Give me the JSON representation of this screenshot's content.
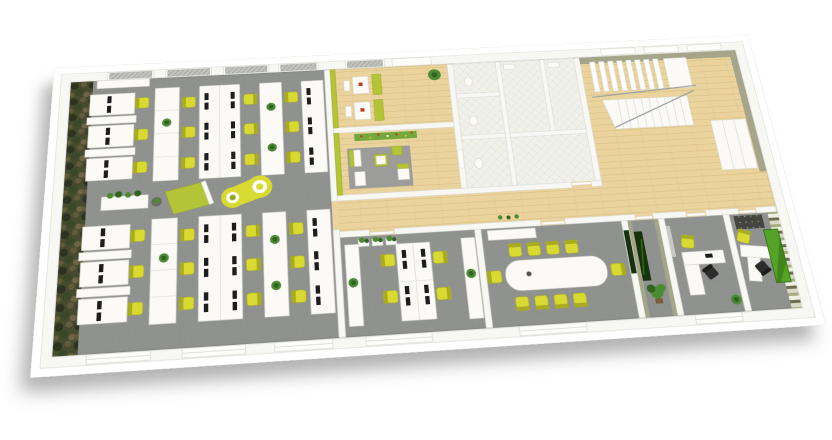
{
  "scene": {
    "description": "3D isometric rendering of a long office floor plan viewed from above at an angle, on a white background with a soft drop shadow",
    "view": "rotated top-down perspective",
    "background": "#ffffff"
  },
  "palette": {
    "background": "#ffffff",
    "rim": "#ffffff",
    "rim_edge": "#e8e8e3",
    "wall": "#f7f7f3",
    "wall_edge": "#d8d8d1",
    "carpet": "#90928f",
    "carpet_line": "#85878480",
    "wood": "#ead39d",
    "wood_line": "#d8bc80",
    "tile": "#f1f1eb",
    "tile_line": "#dddcd0",
    "moss_base": "#474b2e",
    "moss_a": "#2e331f",
    "moss_b": "#615c3b",
    "moss_c": "#6f6547",
    "moss_d": "#3a4827",
    "olive": "#a4a589",
    "olive_dark": "#8b8c70",
    "lime": "#b4c437",
    "lime_dark": "#96a726",
    "yellow": "#d8da31",
    "yellow_dark": "#a9ac20",
    "white_furn": "#fbfaf6",
    "furn_edge": "#d3d3ca",
    "black": "#1d1d1d",
    "chair_black": "#2d2d2d",
    "plant": "#4c8a33",
    "plant_dark": "#2f6420",
    "pot_brown": "#7a5b3a",
    "art_dark": "#16320f",
    "leaf": "#54a326",
    "leaf_dark": "#2e6e14",
    "mural": "#74a83a",
    "mural_red": "#c03a22",
    "mural_yellow": "#d8c437",
    "stripe_a": "#6a6e4f",
    "stripe_b": "#d9dac5",
    "stripe_c": "#a9ad81",
    "stripe_d": "#f0efe3",
    "blind": "#c2c3bf",
    "blind_line": "#93948f",
    "window_white": "#fdfdfb",
    "rug": "#9c9c9a",
    "rug_dark": "#45453f",
    "rail": "#99a0a5"
  },
  "rooms": [
    {
      "id": "open-office",
      "floor": "gray-carpet",
      "workstations": 24,
      "chair_color": "yellow",
      "features": [
        "moss-camo-accent-wall",
        "dual-monitor-desks",
        "white-storage-cabinets",
        "yellow-peanut-lounge-sofa",
        "lime-daybed-board",
        "grass-planter",
        "skylight-blinds"
      ]
    },
    {
      "id": "break-room",
      "floor": "light-wood",
      "features": [
        "two-dining-booths",
        "lime-benches",
        "red-table-flowers",
        "potted-plant"
      ]
    },
    {
      "id": "lounge",
      "floor": "light-wood",
      "features": [
        "flower-meadow-mural",
        "gray-rug",
        "lime-and-white-lounge-chairs"
      ]
    },
    {
      "id": "restrooms",
      "floor": "white-diamond-tile",
      "features": [
        "stall-partitions",
        "sinks",
        "toilets"
      ]
    },
    {
      "id": "stair-hall",
      "floor": "light-wood",
      "features": [
        "staircase-two-flights",
        "metal-railing",
        "white-wardrobe",
        "olive-walls"
      ]
    },
    {
      "id": "corridor",
      "floor": "light-wood",
      "features": [
        "doors-to-all-rooms",
        "small-plants"
      ]
    },
    {
      "id": "team-office",
      "floor": "gray-carpet",
      "workstations": 4,
      "features": [
        "central-bench-desk",
        "two-sideboards-with-plants",
        "three-grass-planters"
      ]
    },
    {
      "id": "conference-room",
      "floor": "gray-carpet",
      "seats": 10,
      "features": [
        "long-white-table",
        "sideboard",
        "dark-green-wall-art"
      ]
    },
    {
      "id": "vestibule",
      "floor": "gray-carpet",
      "features": [
        "dark-green-artwork",
        "bonsai-plant",
        "olive-walls"
      ]
    },
    {
      "id": "office-small",
      "floor": "gray-carpet",
      "workstations": 1,
      "features": [
        "l-shaped-desk",
        "whiteboard",
        "plant",
        "yellow-and-black-chairs"
      ]
    },
    {
      "id": "office-executive",
      "floor": "gray-carpet",
      "workstations": 1,
      "features": [
        "angled-desk",
        "green-striped-feature-wall",
        "big-leaf-artwork",
        "dark-dotted-rug"
      ]
    }
  ]
}
